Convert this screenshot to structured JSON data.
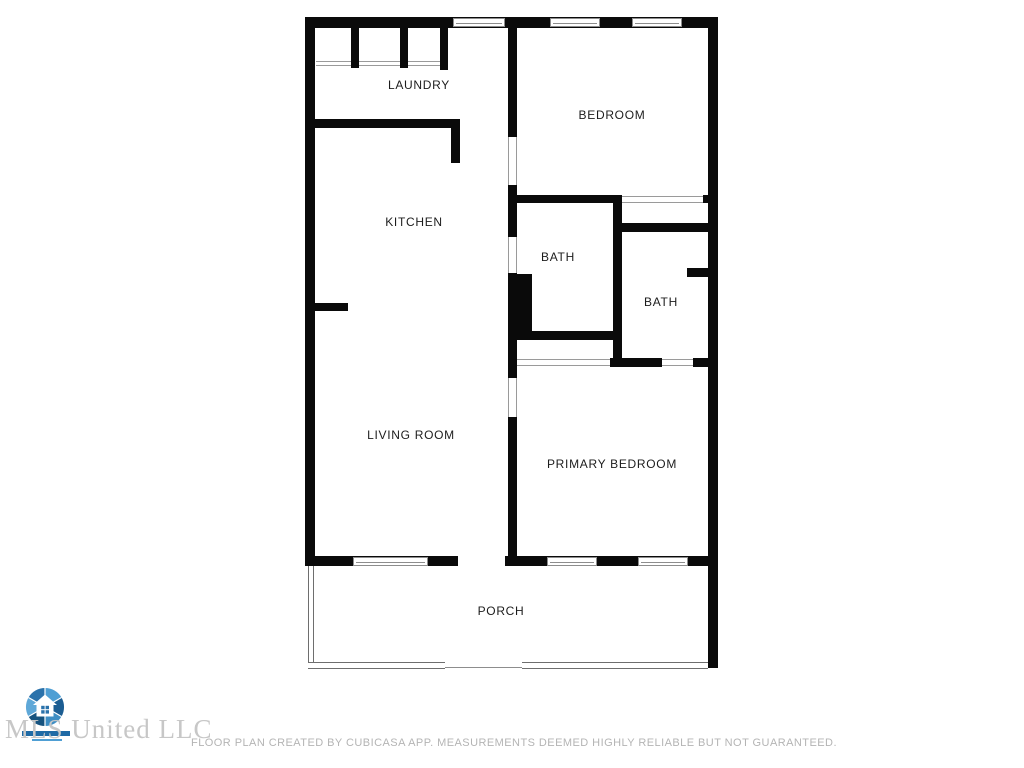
{
  "plan": {
    "rooms": [
      {
        "name": "laundry",
        "label": "LAUNDRY"
      },
      {
        "name": "bedroom",
        "label": "BEDROOM"
      },
      {
        "name": "kitchen",
        "label": "KITCHEN"
      },
      {
        "name": "bath-upper",
        "label": "BATH"
      },
      {
        "name": "bath-right",
        "label": "BATH"
      },
      {
        "name": "living-room",
        "label": "LIVING ROOM"
      },
      {
        "name": "primary-bedroom",
        "label": "PRIMARY BEDROOM"
      },
      {
        "name": "porch",
        "label": "PORCH"
      }
    ],
    "wall_color": "#0a0a0a",
    "opening_line_color": "#9a9a9a"
  },
  "branding": {
    "watermark": "MLS United LLC",
    "logo_icon": "mls-united-shutter-house-logo",
    "logo_blues": [
      "#5fa8d8",
      "#2a72ab",
      "#1b5d92",
      "#3e8ec4",
      "#16537f",
      "#4f9fd4"
    ]
  },
  "footer": {
    "disclaimer": "FLOOR PLAN CREATED BY CUBICASA APP. MEASUREMENTS DEEMED HIGHLY RELIABLE BUT NOT GUARANTEED."
  }
}
